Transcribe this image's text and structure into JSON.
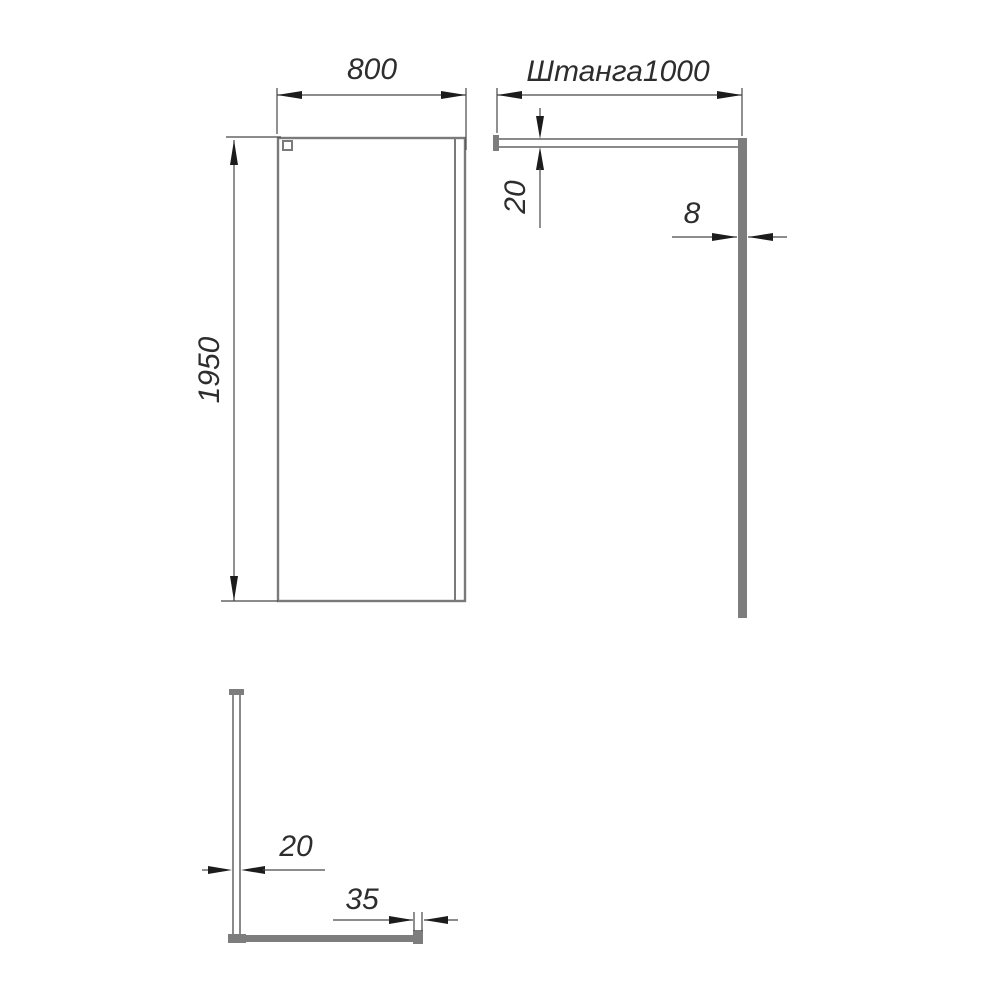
{
  "drawing": {
    "kind": "technical-drawing",
    "subject": "walk-in shower glass panel with support rod"
  },
  "views": {
    "front": {
      "width_dim": "800",
      "height_dim": "1950"
    },
    "side": {
      "rod_dim": "Штанга1000",
      "rod_thickness_dim": "20",
      "glass_thickness_dim": "8"
    },
    "top": {
      "profile_dim": "20",
      "bracket_dim": "35"
    }
  },
  "colors": {
    "outline": "#7a7a7a",
    "panel_fill": "#7d7d7d",
    "dimension_line": "#474747",
    "arrow": "#1c1c1c",
    "text": "#2d2d2d",
    "background": "#ffffff"
  }
}
